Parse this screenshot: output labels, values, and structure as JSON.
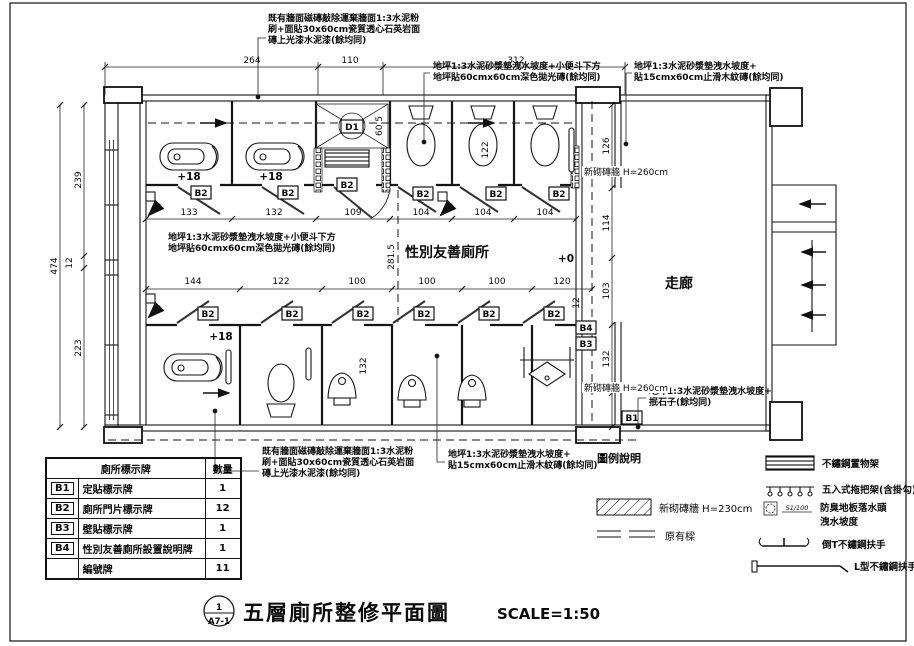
{
  "title_block": {
    "detail_no": "1",
    "sheet_ref": "A7-1",
    "title": "五層廁所整修平面圖",
    "scale": "SCALE=1:50"
  },
  "rooms": {
    "gender_friendly": "性別友善廁所",
    "corridor": "走廊"
  },
  "levels": {
    "plus18": "+18",
    "plus0": "+0"
  },
  "tags": {
    "b1": "B1",
    "b2": "B2",
    "b3": "B3",
    "b4": "B4",
    "d1": "D1"
  },
  "annotations": {
    "wall_spec": [
      "既有牆面磁磚敲除運棄牆面1:3水泥粉",
      "刷+面貼30x60cm瓷質透心石英岩面",
      "磚上光漆水泥漆(餘均同)"
    ],
    "floor_dark_tile": [
      "地坪1:3水泥砂漿墊洩水坡度+小便斗下方",
      "地坪貼60cmx60cm深色拋光磚(餘均同)"
    ],
    "floor_wood_tile": [
      "地坪1:3水泥砂漿墊洩水坡度+",
      "貼15cmx60cm止滑木紋磚(餘均同)"
    ],
    "floor_pebble": [
      "地坪1:3水泥砂漿墊洩水坡度+",
      "抿石子(餘均同)"
    ],
    "new_wall_260": "新砌磚牆 H=260cm"
  },
  "dims": {
    "top": [
      "264",
      "110",
      "312"
    ],
    "left": [
      "474",
      "239",
      "12",
      "223"
    ],
    "r1": [
      "133",
      "132",
      "109",
      "104",
      "104",
      "104"
    ],
    "rm": [
      "144",
      "122",
      "100",
      "100",
      "100",
      "120"
    ],
    "right": [
      "126",
      "114",
      "103",
      "132"
    ],
    "misc": {
      "d605": "60.5",
      "d122": "122",
      "d2815": "281.5",
      "d12": "12",
      "d132": "132"
    }
  },
  "sign_table": {
    "header_name": "廁所標示牌",
    "header_qty": "數量",
    "rows": [
      {
        "tag": "B1",
        "name": "定貼標示牌",
        "qty": "1"
      },
      {
        "tag": "B2",
        "name": "廁所門片標示牌",
        "qty": "12"
      },
      {
        "tag": "B3",
        "name": "壁貼標示牌",
        "qty": "1"
      },
      {
        "tag": "B4",
        "name": "性別友善廁所設置說明牌",
        "qty": "1"
      },
      {
        "tag": "",
        "name": "編號牌",
        "qty": "11"
      }
    ]
  },
  "legend": {
    "title": "圖例說明",
    "new_wall_230": "新砌磚牆 H=230cm",
    "beam": "原有樑",
    "shelf": "不鏽鋼置物架",
    "mop_rack": "五入式拖把架(含掛勾)",
    "drain_slope_code": "S1/100",
    "drain_line1": "防臭地板落水頭",
    "drain_line2": "洩水坡度",
    "t_grab": "倒T不鏽鋼扶手",
    "l_grab": "L型不鏽鋼扶手"
  }
}
